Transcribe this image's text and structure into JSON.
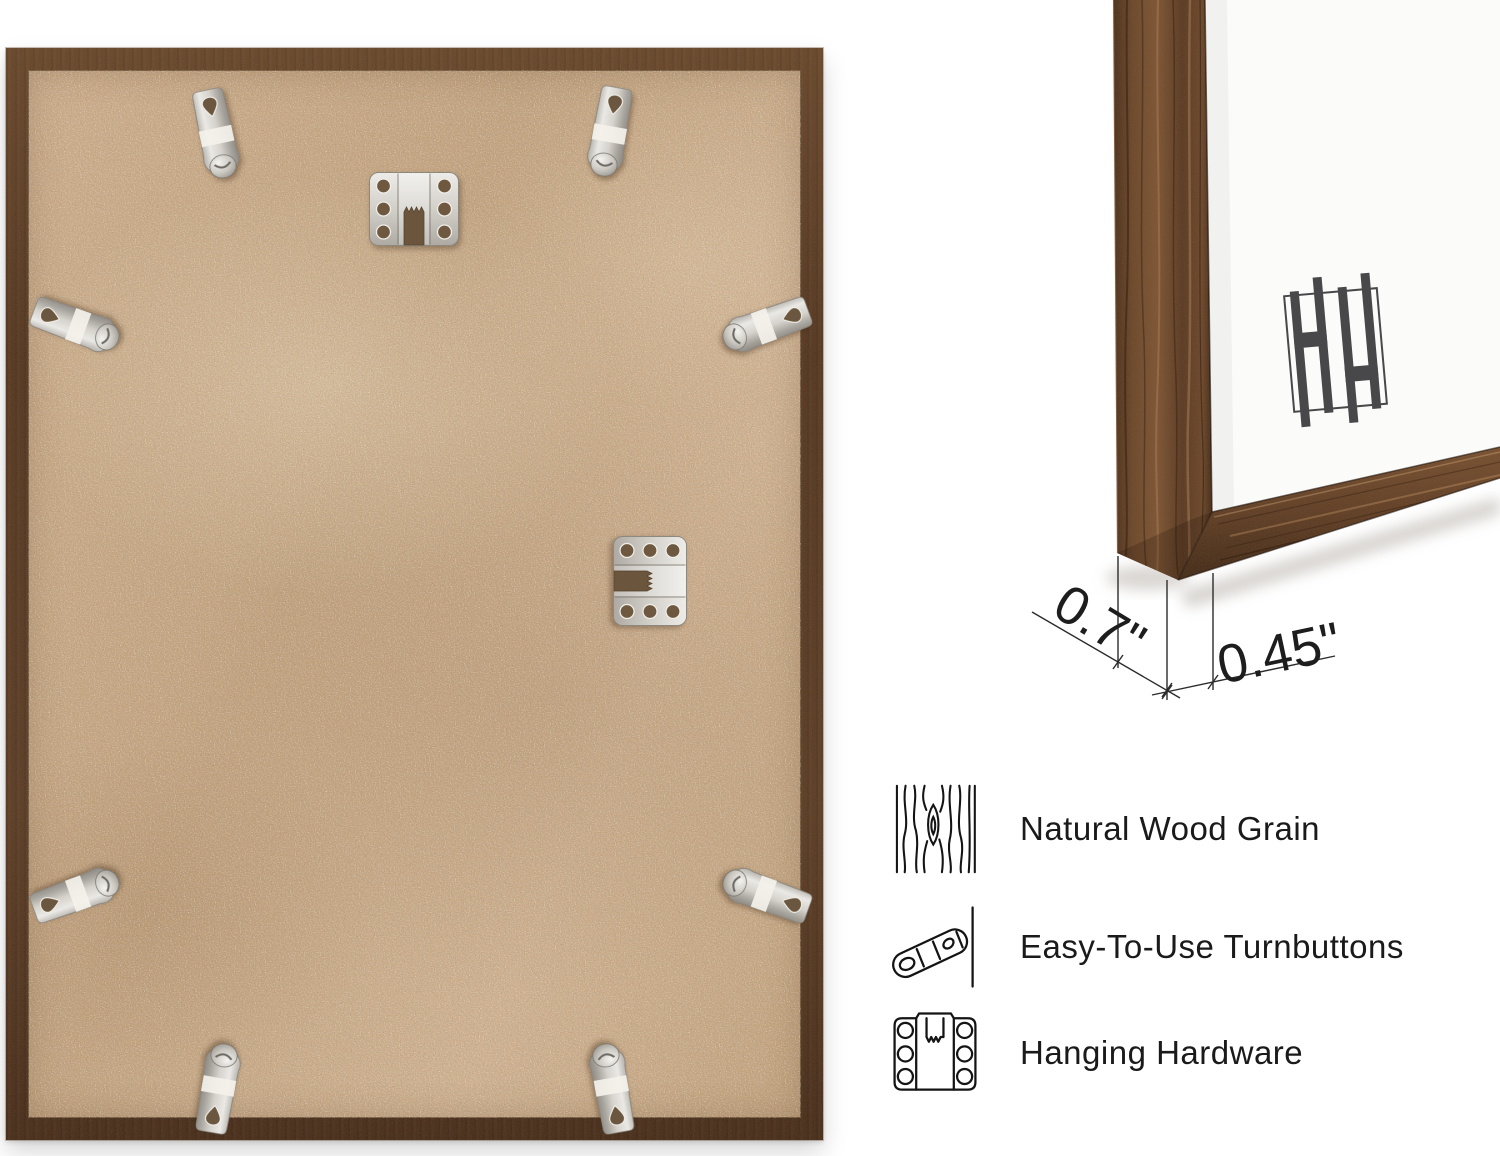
{
  "measurements": {
    "depth": "0.7\"",
    "face_width": "0.45\""
  },
  "features": {
    "items": [
      {
        "icon": "wood-grain-icon",
        "label": "Natural Wood Grain"
      },
      {
        "icon": "turnbutton-icon",
        "label": "Easy-To-Use Turnbuttons"
      },
      {
        "icon": "hanging-hardware-icon",
        "label": "Hanging Hardware"
      }
    ]
  },
  "logo": {
    "name": "hh-monogram"
  },
  "hardware": {
    "turnbuttons": 8,
    "sawtooth_hangers": 2
  },
  "colors": {
    "frame_wood": "#573A24",
    "detail_wood": "#6E4A2E",
    "mdf_panel": "#C9AC8B",
    "metal": "#D6D3CD",
    "mat": "#FBFBFA",
    "logo": "#48484A",
    "text": "#1A1A1A",
    "background": "#FFFFFF"
  }
}
